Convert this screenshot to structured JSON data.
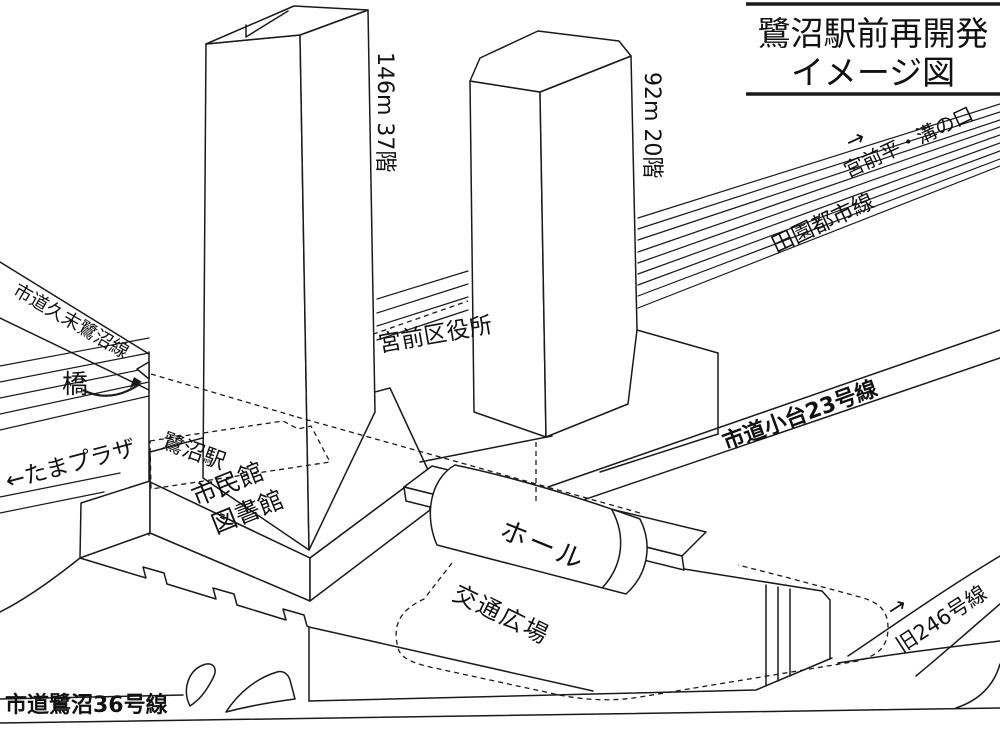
{
  "title": {
    "line1": "鷺沼駅前再開発",
    "line2": "イメージ図"
  },
  "buildings": {
    "tower_main_label": "146m 37階",
    "tower_sub_label": "92m 20階",
    "ward_office": "宮前区役所",
    "civic_hall_line1": "市民館",
    "civic_hall_line2": "図書館",
    "hall": "ホール",
    "station": "鷺沼駅",
    "plaza": "交通広場",
    "bridge": "橋"
  },
  "roads": {
    "hisasue_saginuma": "市道久末鷺沼線",
    "saginuma36": "市道鷺沼36号線",
    "odai23": "市道小台23号線",
    "old246": "旧246号線",
    "old246_arrow": "→"
  },
  "railway": {
    "line_name": "田園都市線",
    "dir_east_arrow": "→",
    "dir_east": "宮前平・溝の口",
    "dir_west": "←たまプラザ"
  },
  "colors": {
    "line": "#1a1a1a",
    "background": "#ffffff"
  }
}
